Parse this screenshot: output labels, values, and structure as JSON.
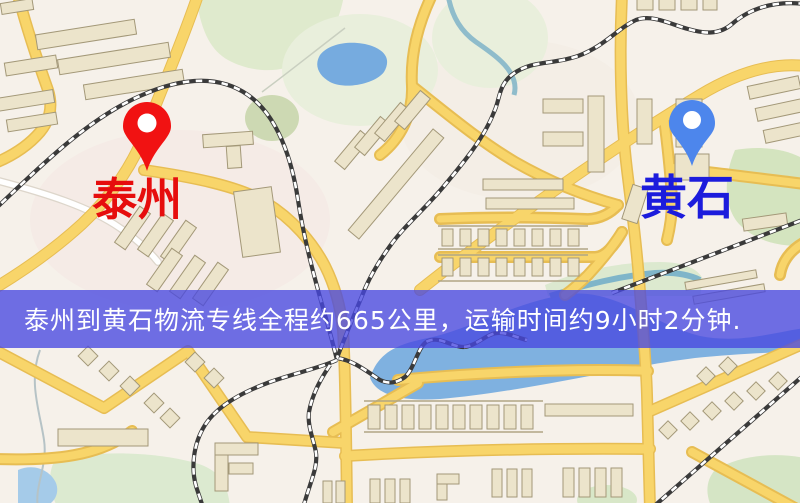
{
  "banner": {
    "text": "泰州到黄石物流专线全程约665公里，运输时间约9小时2分钟.",
    "background_color": "#4848e0",
    "text_color": "#ffffff"
  },
  "markers": {
    "origin": {
      "label": "泰州",
      "pin_color": "#f11212",
      "label_color": "#e60d0d"
    },
    "destination": {
      "label": "黄石",
      "pin_color": "#4d86ec",
      "label_color": "#1c1cdc"
    }
  },
  "map_palette": {
    "background": "#f6f1ea",
    "road_major_fill": "#f8d56a",
    "road_major_casing": "#e7bd53",
    "road_minor": "#ffffff",
    "park_green": "#dcead0",
    "water_blue": "#7fb1e0",
    "railway_dark": "#3a3a3a",
    "building_fill": "#ece4cb"
  }
}
